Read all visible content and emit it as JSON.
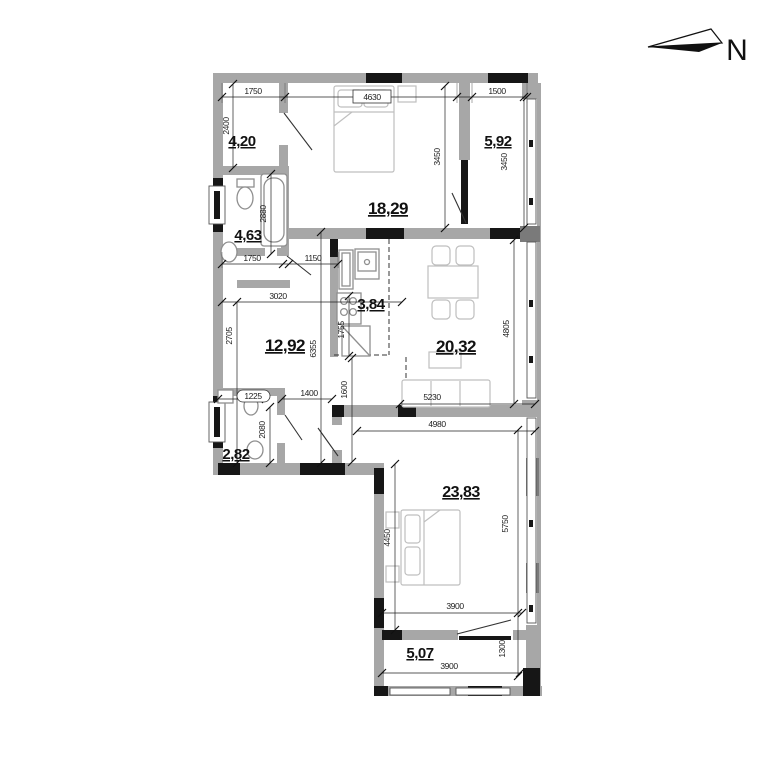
{
  "north": {
    "label": "N"
  },
  "rooms": [
    {
      "name": "entry-hall",
      "area": "4,20"
    },
    {
      "name": "bedroom-1",
      "area": "18,29"
    },
    {
      "name": "loggia",
      "area": "5,92"
    },
    {
      "name": "bathroom",
      "area": "4,63"
    },
    {
      "name": "kitchen",
      "area": "3,84"
    },
    {
      "name": "corridor",
      "area": "12,92"
    },
    {
      "name": "living-room",
      "area": "20,32"
    },
    {
      "name": "wc",
      "area": "2,82"
    },
    {
      "name": "bedroom-2",
      "area": "23,83"
    },
    {
      "name": "balcony",
      "area": "5,07"
    }
  ],
  "dims": [
    "1750",
    "4630",
    "1500",
    "2400",
    "3450",
    "3450",
    "2880",
    "1750",
    "1150",
    "3020",
    "2705",
    "6355",
    "1755",
    "1600",
    "1400",
    "1225",
    "2080",
    "5230",
    "4805",
    "4980",
    "4450",
    "5750",
    "3900",
    "3900",
    "1300"
  ],
  "colors": {
    "wall_gray": "#a7a7a7",
    "wall_dark": "#7a7a7a",
    "wall_black": "#161616",
    "dim_color": "#1d1d1d"
  }
}
